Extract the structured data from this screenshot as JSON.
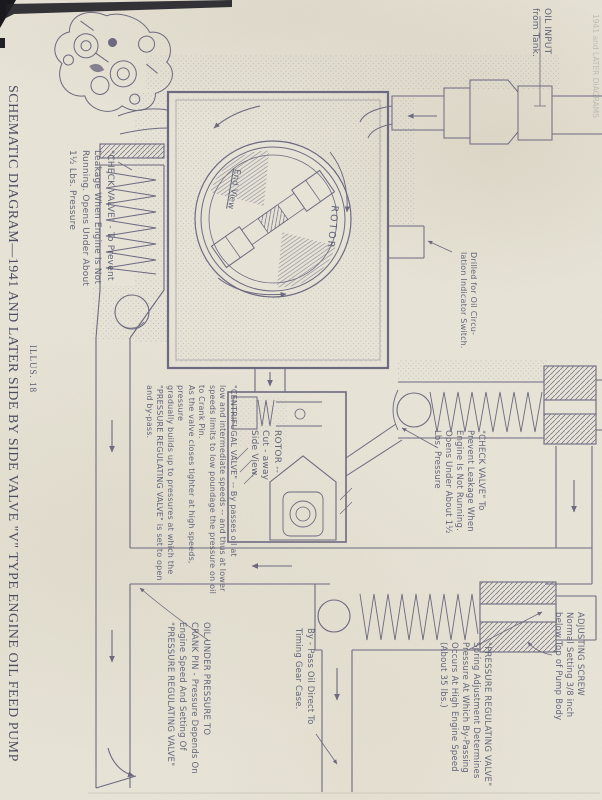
{
  "page": {
    "title": "SCHEMATIC DIAGRAM—1941 AND LATER SIDE BY SIDE VALVE \"V\" TYPE ENGINE OIL FEED PUMP",
    "illus": "ILLUS. 18",
    "edge_note": "1941 and LATER DIAGRAMS",
    "paper_color": "#e9e5d8",
    "ink_color": "#6b6880"
  },
  "labels": {
    "oil_input": {
      "text": "OIL INPUT\nfrom   Tank."
    },
    "check_valve_left": {
      "text": "\"CHECK VALVE\" - To  Prevent\nLeakage  When  Engine  Is  Not\nRunning.   Opens  Under  About\n1½  Lbs.   Pressure"
    },
    "end_view": {
      "text": "End View"
    },
    "rotor_end_view": {
      "text": "ROTOR"
    },
    "drilled_switch": {
      "text": "Drilled  for  Oil  Circu-\nlation  Indicator  Switch."
    },
    "centrifugal_valve": {
      "text": "\"CENTRIFUGAL  VALVE\" -- By  passes  oil  at\nlow  and  intermediate  speeds -- and  thus  at  lower\nspeeds  limits  to  low  poundage  the  pressure  on  oil\nto  Crank  Pin.\nAs  the  valve  closes  tighter  at  high  speeds,  pressure\ngradually  builds  up  to  pressures  at  which  the\n\"PRESSURE  REGULATING  VALVE\"  is  set  to  open\nand  by-pass."
    },
    "rotor_side_view": {
      "text": "ROTOR --\nCut - away\nSide  View."
    },
    "check_valve_right": {
      "text": "\"CHECK  VALVE\"  To\nPrevent  Leakage  When\nEngine  Is  Not  Running.\nOpens  Under  About  1½\nLbs.  Pressure"
    },
    "oil_under_pressure": {
      "text": "OIL  UNDER  PRESSURE  TO\nCRANK PIN - Pressure  Depends  On\nEngine  Speed  And  Setting  Of\n\"PRESSURE  REGULATING  VALVE\""
    },
    "bypass": {
      "text": "By - Pass  Oil  Direct  To\nTiming  Gear  Case."
    },
    "pressure_regulating": {
      "text": "\"PRESSURE  REGULATING  VALVE\"\nSpring  Adjustment  Determines\nPressure  At  Which  By-Passing\nOccurs  At  High  Engine  Speed\n(About  35  lbs.)"
    },
    "adjusting_screw": {
      "text": "ADJUSTING  SCREW\nNormal  Setting  3/8 inch\nbelow  Top  of  Pump  Body"
    }
  }
}
